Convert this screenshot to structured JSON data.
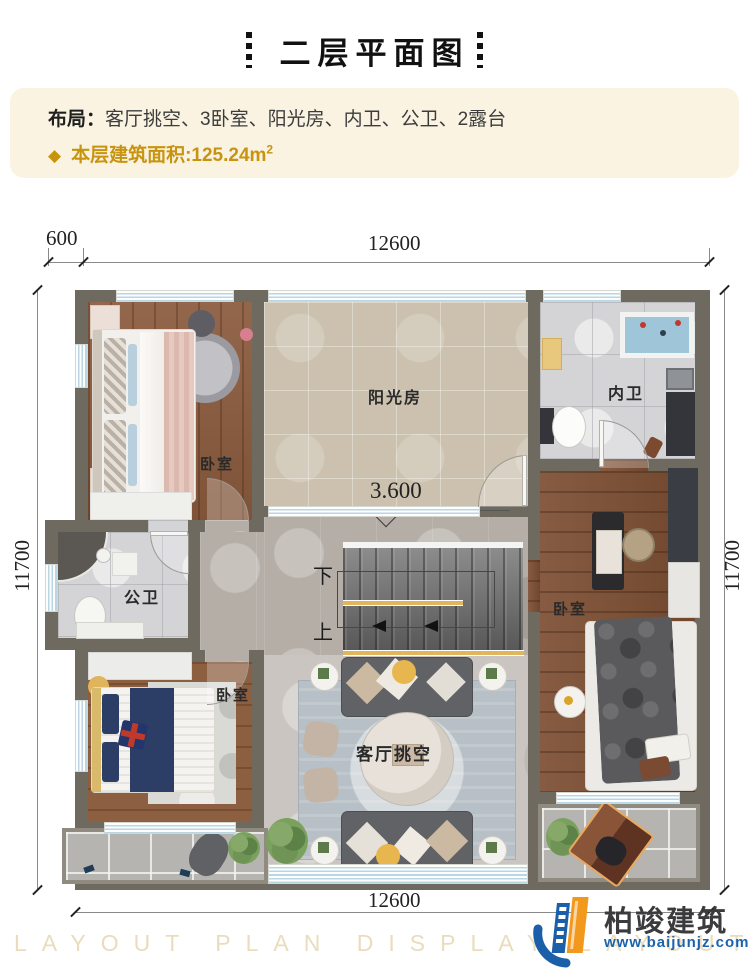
{
  "title": {
    "text": "二层平面图"
  },
  "info": {
    "layout_label": "布局：",
    "layout_value": "客厅挑空、3卧室、阳光房、内卫、公卫、2露台",
    "bullet": "◆",
    "area_label": "本层建筑面积:",
    "area_value": "125.24m",
    "area_sup": "2",
    "accent_color": "#c8940f",
    "panel_bg": "#faf3e2"
  },
  "dims": {
    "offset": "600",
    "top": "12600",
    "left": "11700",
    "right": "11700",
    "bottom": "12600"
  },
  "rooms": {
    "bedroom_top_left": "卧室",
    "sunroom": "阳光房",
    "inner_bath": "内卫",
    "public_bath": "公卫",
    "bedroom_right": "卧室",
    "bedroom_bottom_left": "卧室",
    "living_void": "客厅挑空"
  },
  "stairs": {
    "elevation": "3.600",
    "down_label": "下",
    "up_label": "上"
  },
  "footer": {
    "watermark": "LAYOUT PLAN DISPLAY LAYOUT PLAN DISPLAY",
    "brand": "柏竣建筑",
    "site": "www.baijunjz.com"
  }
}
